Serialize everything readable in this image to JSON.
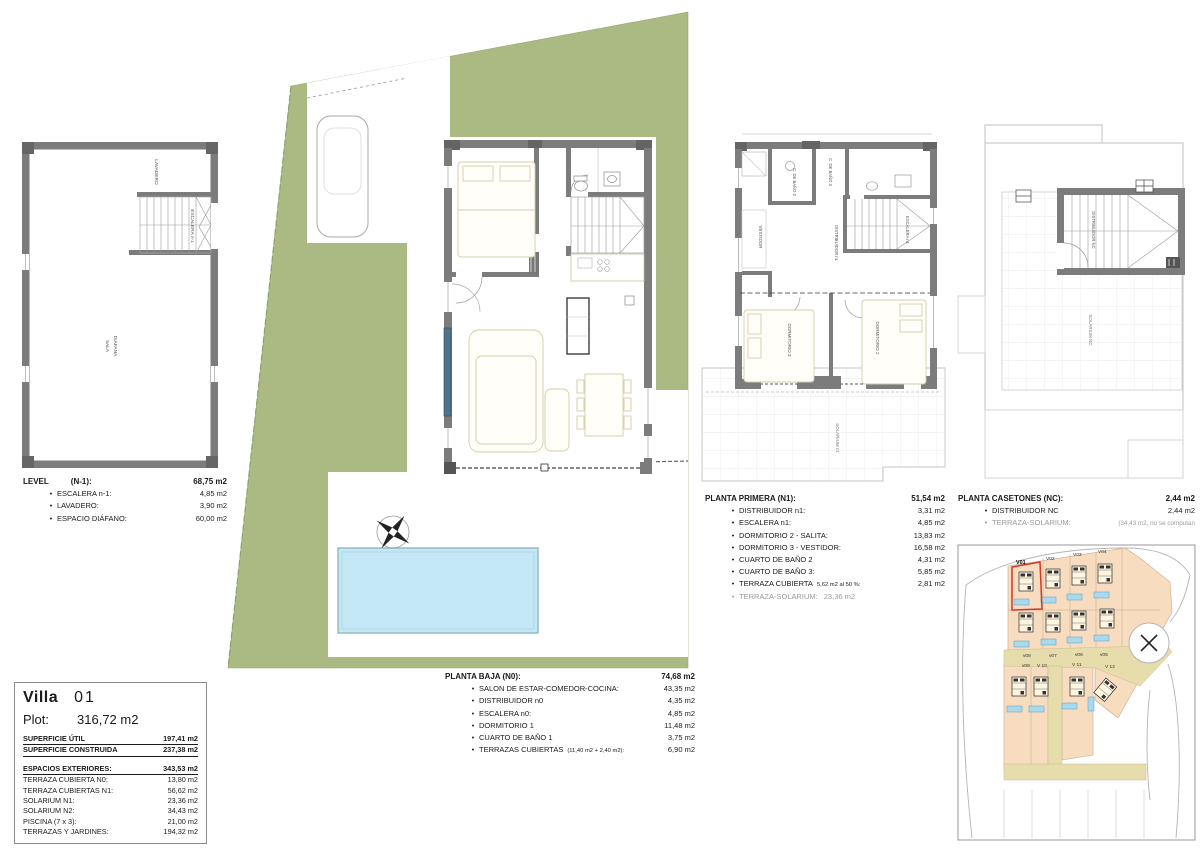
{
  "colors": {
    "plot_green": "#aaba82",
    "pool_blue": "#c3e7f4",
    "wall_gray": "#7c7c7c",
    "map_plot_peach": "#f7dcc0",
    "map_road_tan": "#e7dcab",
    "map_pool_blue": "#a9d9ee",
    "highlight_red": "#cf3a28",
    "muted_text": "#9a9a9a"
  },
  "level_n1": {
    "labels": {
      "lavadero": "LAVADERO",
      "escalera": "ESCALERA n-1",
      "sala_line1": "SALA",
      "sala_line2": "DIÁFANA"
    },
    "legend": {
      "title": "LEVEL",
      "paren": "(N-1):",
      "total": "68,75 m2",
      "items": [
        {
          "label": "ESCALERA n-1:",
          "value": "4,85 m2"
        },
        {
          "label": "LAVADERO:",
          "value": "3,90 m2"
        },
        {
          "label": "ESPACIO DIÁFANO:",
          "value": "60,00 m2"
        }
      ]
    }
  },
  "planta_baja": {
    "legend": {
      "title": "PLANTA BAJA (N0):",
      "total": "74,68 m2",
      "items": [
        {
          "label": "SALON DE ESTAR-COMEDOR-COCINA:",
          "note": "",
          "value": "43,35 m2"
        },
        {
          "label": "DISTRIBUIDOR n0",
          "note": "",
          "value": "4,35 m2"
        },
        {
          "label": "ESCALERA n0:",
          "note": "",
          "value": "4,85 m2"
        },
        {
          "label": "DORMITORIO  1",
          "note": "",
          "value": "11,48 m2"
        },
        {
          "label": "CUARTO DE BAÑO 1",
          "note": "",
          "value": "3,75 m2"
        },
        {
          "label": "TERRAZAS CUBIERTAS",
          "note": "(11,40 m2 + 2,40 m2):",
          "value": "6,90 m2"
        }
      ]
    }
  },
  "planta_primera": {
    "labels": {
      "vestidor": "VESTIDOR",
      "bano2": "C. DE BAÑO 2",
      "bano3": "C. DE BAÑO 3",
      "distribuidor": "DISTRIBUIDOR n1",
      "escalera": "ESCALERA n1",
      "dorm3": "DORMITORIO 3",
      "dorm2": "DORMITORIO 2",
      "solarium": "SOLARIUM n1"
    },
    "legend": {
      "title": "PLANTA PRIMERA (N1):",
      "total": "51,54 m2",
      "items": [
        {
          "label": "DISTRIBUIDOR  n1:",
          "note": "",
          "value": "3,31 m2"
        },
        {
          "label": "ESCALERA  n1:",
          "note": "",
          "value": "4,85 m2"
        },
        {
          "label": "DORMITORIO  2 - SALITA:",
          "note": "",
          "value": "13,83 m2"
        },
        {
          "label": "DORMITORIO 3 - VESTIDOR:",
          "note": "",
          "value": "16,58 m2"
        },
        {
          "label": "CUARTO DE BAÑO 2",
          "note": "",
          "value": "4,31 m2"
        },
        {
          "label": "CUARTO DE BAÑO 3:",
          "note": "",
          "value": "5,85 m2"
        },
        {
          "label": "TERRAZA CUBIERTA",
          "note": "5,62 m2 al 50 %:",
          "value": "2,81 m2"
        }
      ],
      "muted_item": {
        "label": "TERRAZA-SOLARIUM:",
        "value": "23,36 m2"
      }
    }
  },
  "planta_casetones": {
    "labels": {
      "distribuidor": "DISTRIBUIDOR NC",
      "solarium": "SOLARIUM NC"
    },
    "legend": {
      "title": "PLANTA CASETONES (NC):",
      "total": "2,44 m2",
      "items": [
        {
          "label": "DISTRIBUIDOR NC",
          "value": "2,44 m2"
        }
      ],
      "muted_item": {
        "label": "TERRAZA-SOLARIUM:",
        "value": "(34,43 m2, no se computan"
      }
    }
  },
  "villa_info": {
    "title": "Villa",
    "number": "01",
    "plot_label": "Plot:",
    "plot_value": "316,72 m2",
    "rows": [
      {
        "label": "SUPERFICIE ÚTIL",
        "value": "197,41 m2"
      },
      {
        "label": "SUPERFICIE CONSTRUIDA",
        "value": "237,38 m2"
      }
    ],
    "ext_header": {
      "label": "ESPACIOS EXTERIORES:",
      "value": "343,53 m2"
    },
    "ext_rows": [
      {
        "label": "TERRAZA CUBIERTA N0:",
        "value": "13,80 m2"
      },
      {
        "label": "TERRAZA CUBIERTAS N1:",
        "value": "56,62 m2"
      },
      {
        "label": "SOLARIUM  N1:",
        "value": "23,36 m2"
      },
      {
        "label": "SOLARIUM  N2:",
        "value": "34,43 m2"
      },
      {
        "label": "PISCINA  (7 x 3):",
        "value": "21,00 m2"
      },
      {
        "label": "TERRAZAS Y JARDINES:",
        "value": "194,32 m2"
      }
    ]
  },
  "site_map": {
    "highlighted_plot": "V01",
    "labels": [
      "V01",
      "V02",
      "V03",
      "V04",
      "v05",
      "v06",
      "v07",
      "v08",
      "v09",
      "V 10",
      "V 11",
      "V 12"
    ]
  }
}
